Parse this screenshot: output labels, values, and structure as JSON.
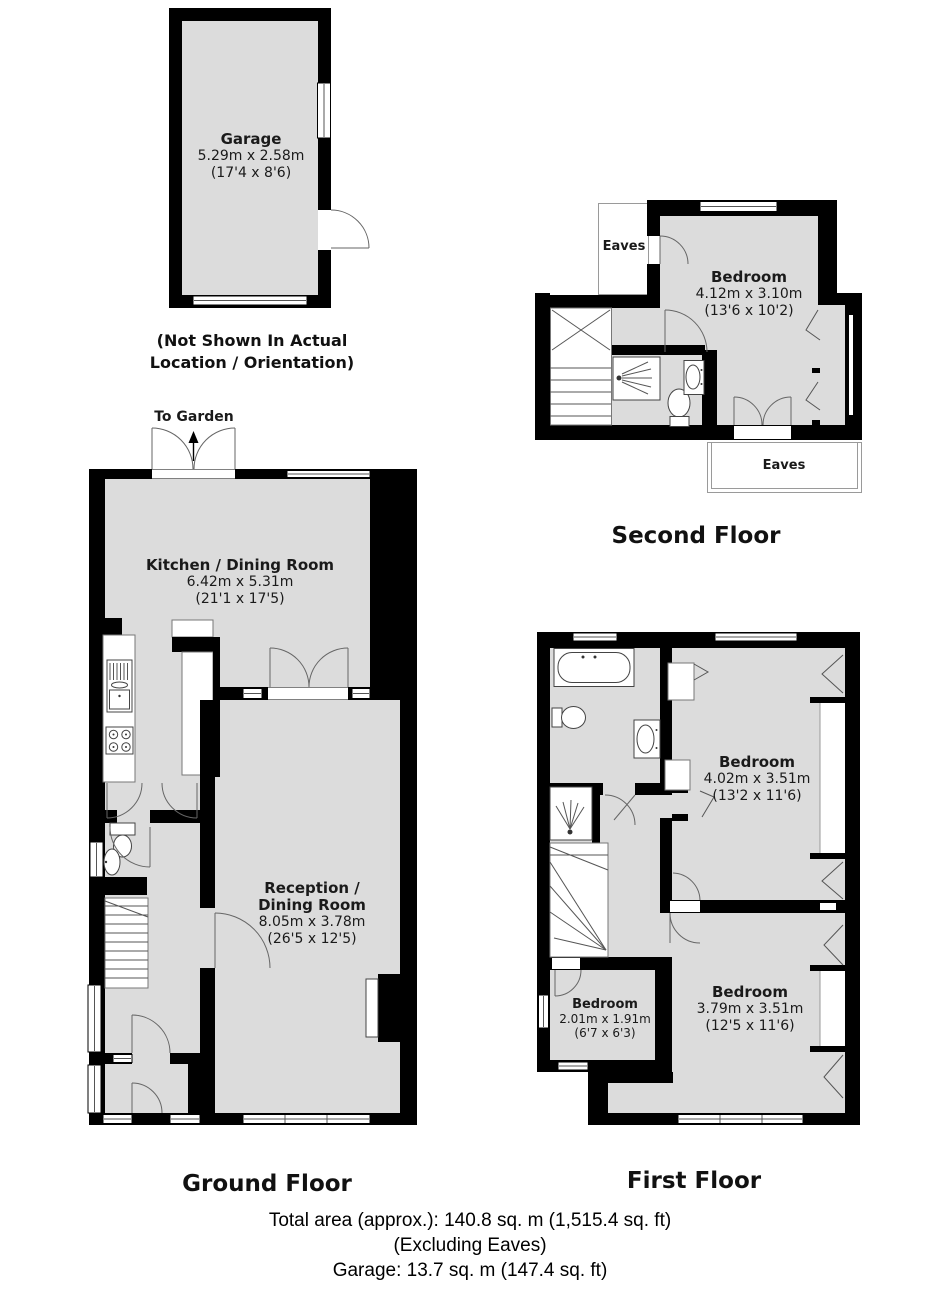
{
  "garage_plan": {
    "room": {
      "name": "Garage",
      "metric": "5.29m x 2.58m",
      "imperial": "(17'4 x 8'6)"
    },
    "note_line1": "(Not Shown In Actual",
    "note_line2": "Location / Orientation)"
  },
  "second_floor": {
    "title": "Second Floor",
    "eaves_top": "Eaves",
    "eaves_bottom": "Eaves",
    "bedroom": {
      "name": "Bedroom",
      "metric": "4.12m x 3.10m",
      "imperial": "(13'6 x 10'2)"
    }
  },
  "ground_floor": {
    "title": "Ground Floor",
    "to_garden": "To Garden",
    "kitchen": {
      "name": "Kitchen / Dining Room",
      "metric": "6.42m x 5.31m",
      "imperial": "(21'1 x 17'5)"
    },
    "reception": {
      "name_line1": "Reception /",
      "name_line2": "Dining Room",
      "metric": "8.05m x 3.78m",
      "imperial": "(26'5 x 12'5)"
    }
  },
  "first_floor": {
    "title": "First Floor",
    "bedroom_front": {
      "name": "Bedroom",
      "metric": "4.02m x 3.51m",
      "imperial": "(13'2 x 11'6)"
    },
    "bedroom_small": {
      "name": "Bedroom",
      "metric": "2.01m x 1.91m",
      "imperial": "(6'7 x 6'3)"
    },
    "bedroom_back": {
      "name": "Bedroom",
      "metric": "3.79m x 3.51m",
      "imperial": "(12'5 x 11'6)"
    }
  },
  "summary": {
    "line1": "Total area (approx.): 140.8 sq. m (1,515.4 sq. ft)",
    "line2": "(Excluding Eaves)",
    "line3": "Garage: 13.7 sq. m (147.4 sq. ft)"
  },
  "colors": {
    "wall": "#000000",
    "room_fill": "#dcdcdc",
    "door_arc": "#666666",
    "eaves_outline": "#9a9a9a"
  }
}
